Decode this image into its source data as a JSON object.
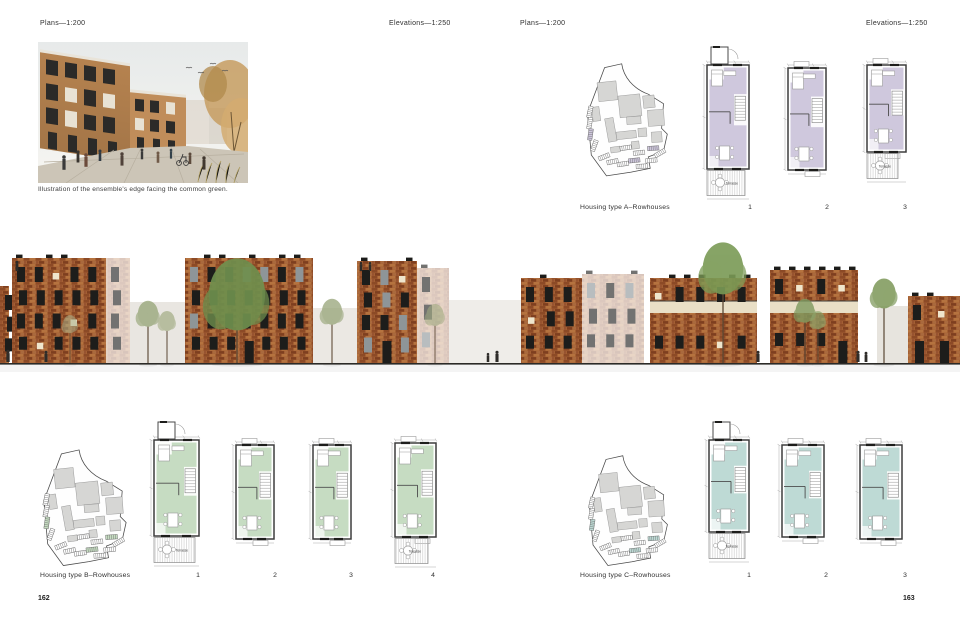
{
  "spread": {
    "left_page": {
      "plans_scale_label": "Plans—1:200",
      "elevations_scale_label": "Elevations—1:250",
      "photo_caption": "Illustration of the ensemble's edge facing the common green.",
      "page_number": "162",
      "type_b": {
        "label": "Housing type B–Rowhouses",
        "plan_numbers": [
          "1",
          "2",
          "3",
          "4"
        ]
      }
    },
    "right_page": {
      "plans_scale_label": "Plans—1:200",
      "elevations_scale_label": "Elevations—1:250",
      "page_number": "163",
      "type_a": {
        "label": "Housing type A–Rowhouses",
        "plan_numbers": [
          "1",
          "2",
          "3"
        ]
      },
      "type_c": {
        "label": "Housing type C–Rowhouses",
        "plan_numbers": [
          "1",
          "2",
          "3"
        ]
      }
    }
  },
  "plan_annotations": {
    "terrace_label": "Terrasse"
  },
  "colors": {
    "plan_fill_type_a": "#cfc8dd",
    "plan_fill_type_b": "#c6dcc2",
    "plan_fill_type_c": "#bedad5",
    "brick": "#a35f33",
    "brick_dark": "#8c4a26",
    "brick_light": "#b5733f",
    "window_dark": "#1d1d1b",
    "window_cream": "#efe6cd",
    "site_block_gray": "#d6d6d4",
    "ground_line": "#2b2a27"
  }
}
